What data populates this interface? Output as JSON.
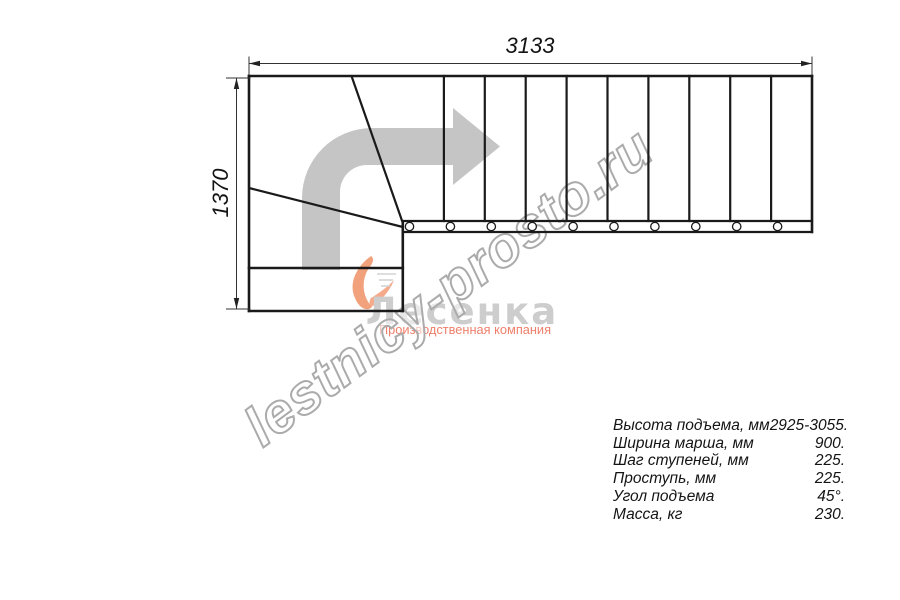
{
  "dimensions": {
    "width_label": "3133",
    "height_label": "1370"
  },
  "watermark": {
    "text": "lestnicy-prosto.ru"
  },
  "logo": {
    "name": "Лесенка",
    "tagline": "Производственная компания"
  },
  "specs": {
    "rows": [
      {
        "label": "Высота подъема, мм",
        "value": "2925-3055."
      },
      {
        "label": "Ширина марша, мм",
        "value": "900."
      },
      {
        "label": "Шаг ступеней, мм",
        "value": "225."
      },
      {
        "label": "Проступь, мм",
        "value": "225."
      },
      {
        "label": "Угол подъема",
        "value": "45°."
      },
      {
        "label": "Масса, кг",
        "value": "230."
      }
    ]
  },
  "colors": {
    "line": "#1a1a1a",
    "dimension_line": "#333333",
    "direction_arrow": "#c5c5c5",
    "watermark_outline": "#ababab",
    "logo_gray": "#cdcdcd",
    "logo_salmon": "#ee7f6a",
    "swoosh_orange": "#f09066"
  }
}
